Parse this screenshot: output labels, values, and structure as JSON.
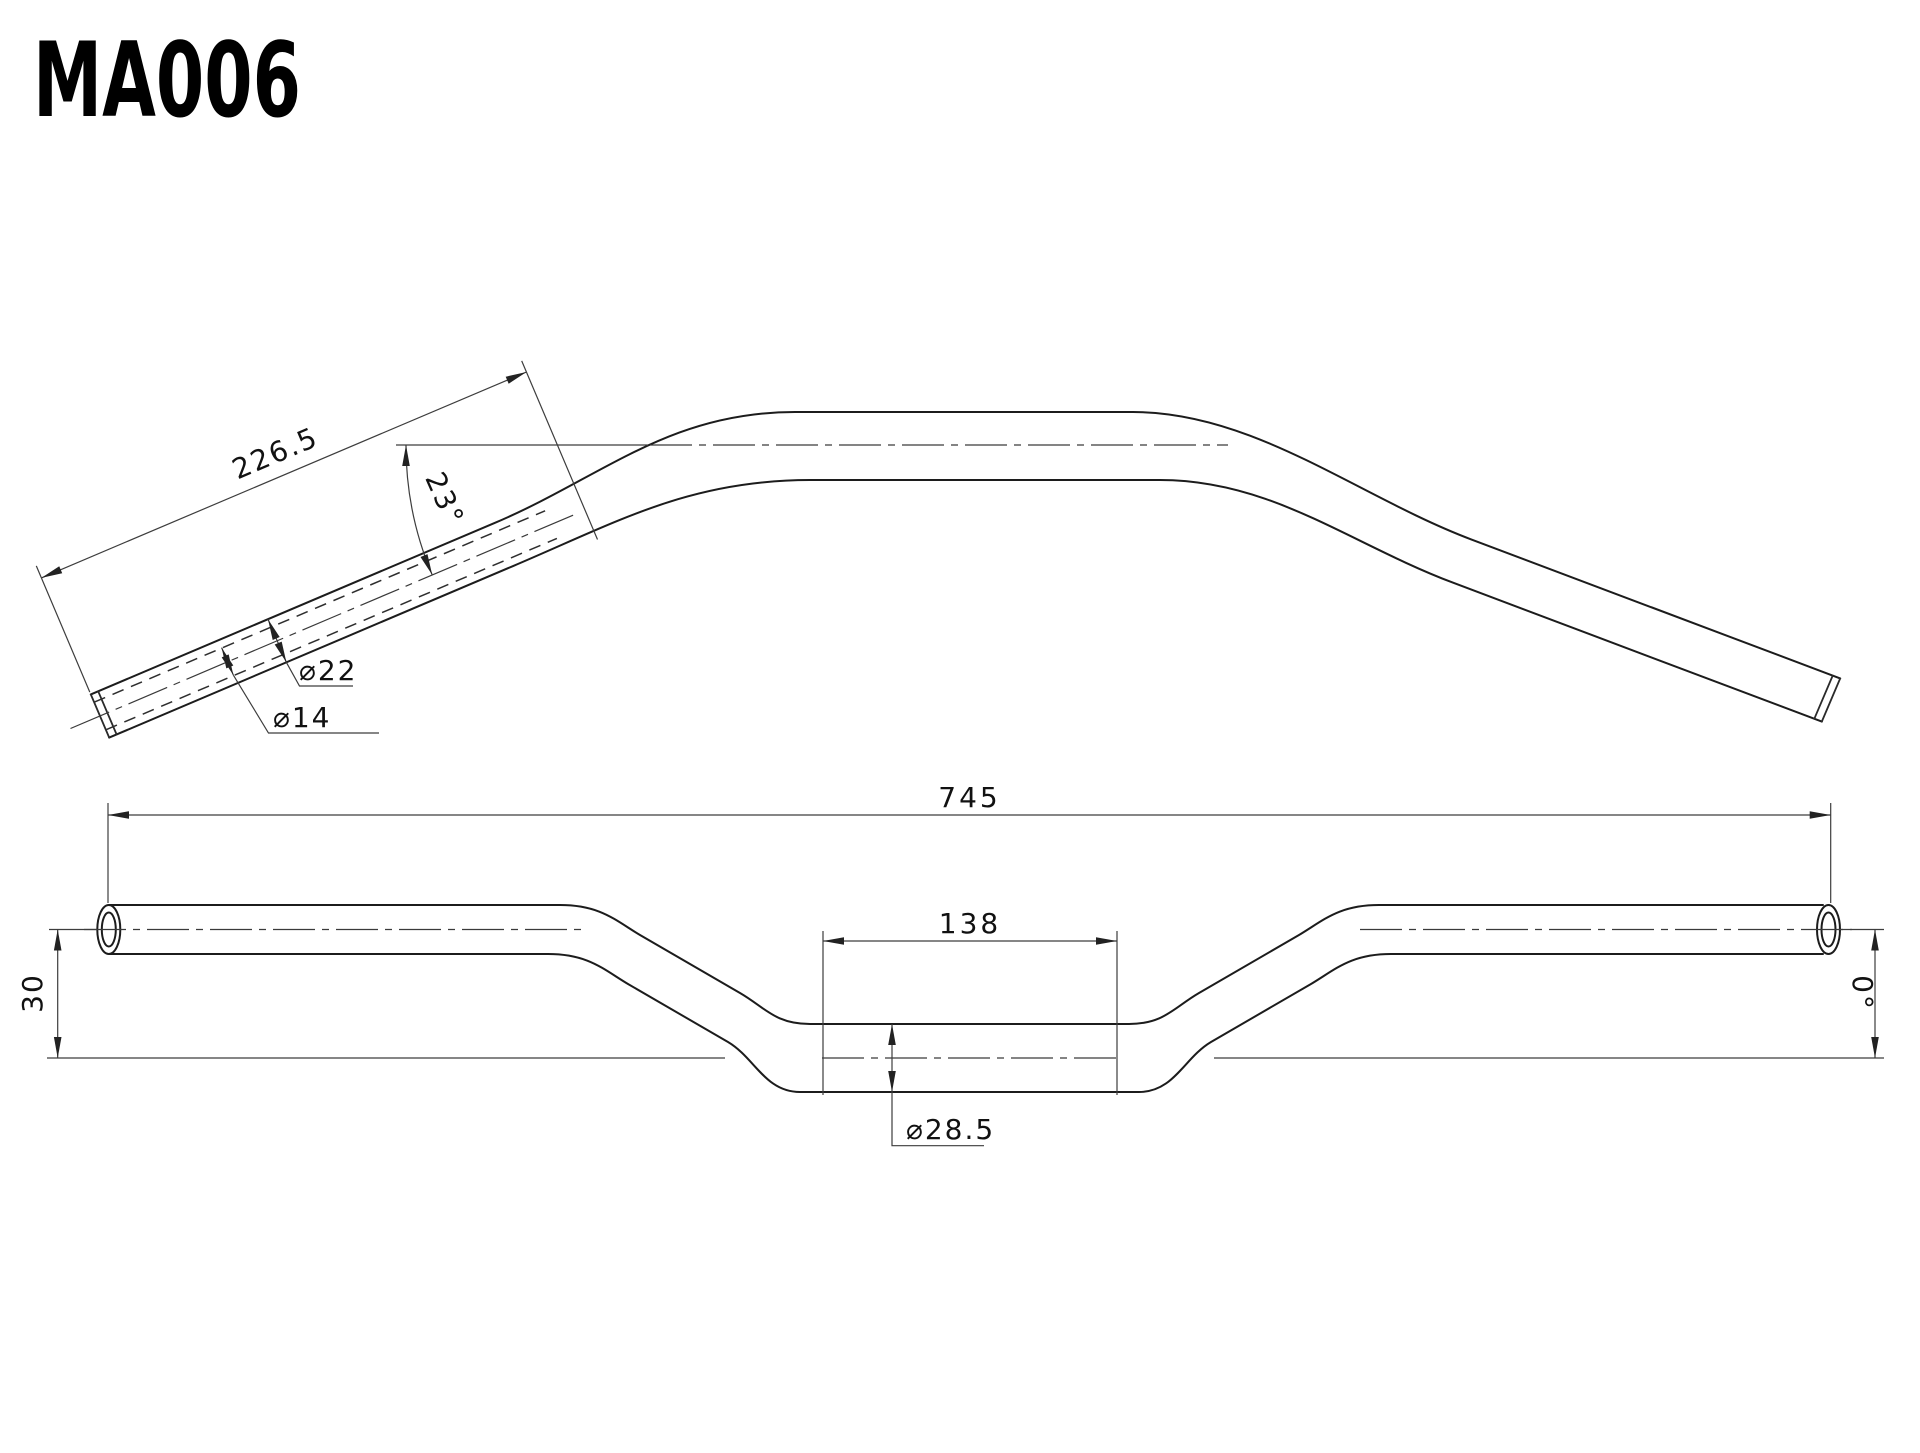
{
  "title": "MA006",
  "drawing": {
    "colors": {
      "line": "#1c1c1c",
      "dimension_line": "#3d3d3d",
      "background": "#ffffff"
    },
    "top_view": {
      "labels": {
        "grip_length": "226.5",
        "pullback_angle": "23°",
        "grip_outer_diameter": "⌀22",
        "grip_inner_diameter": "⌀14"
      }
    },
    "front_view": {
      "labels": {
        "overall_width": "745",
        "clamp_section_width": "138",
        "clamp_diameter": "⌀28.5",
        "rise": "30",
        "end_angle": "0°"
      }
    }
  }
}
